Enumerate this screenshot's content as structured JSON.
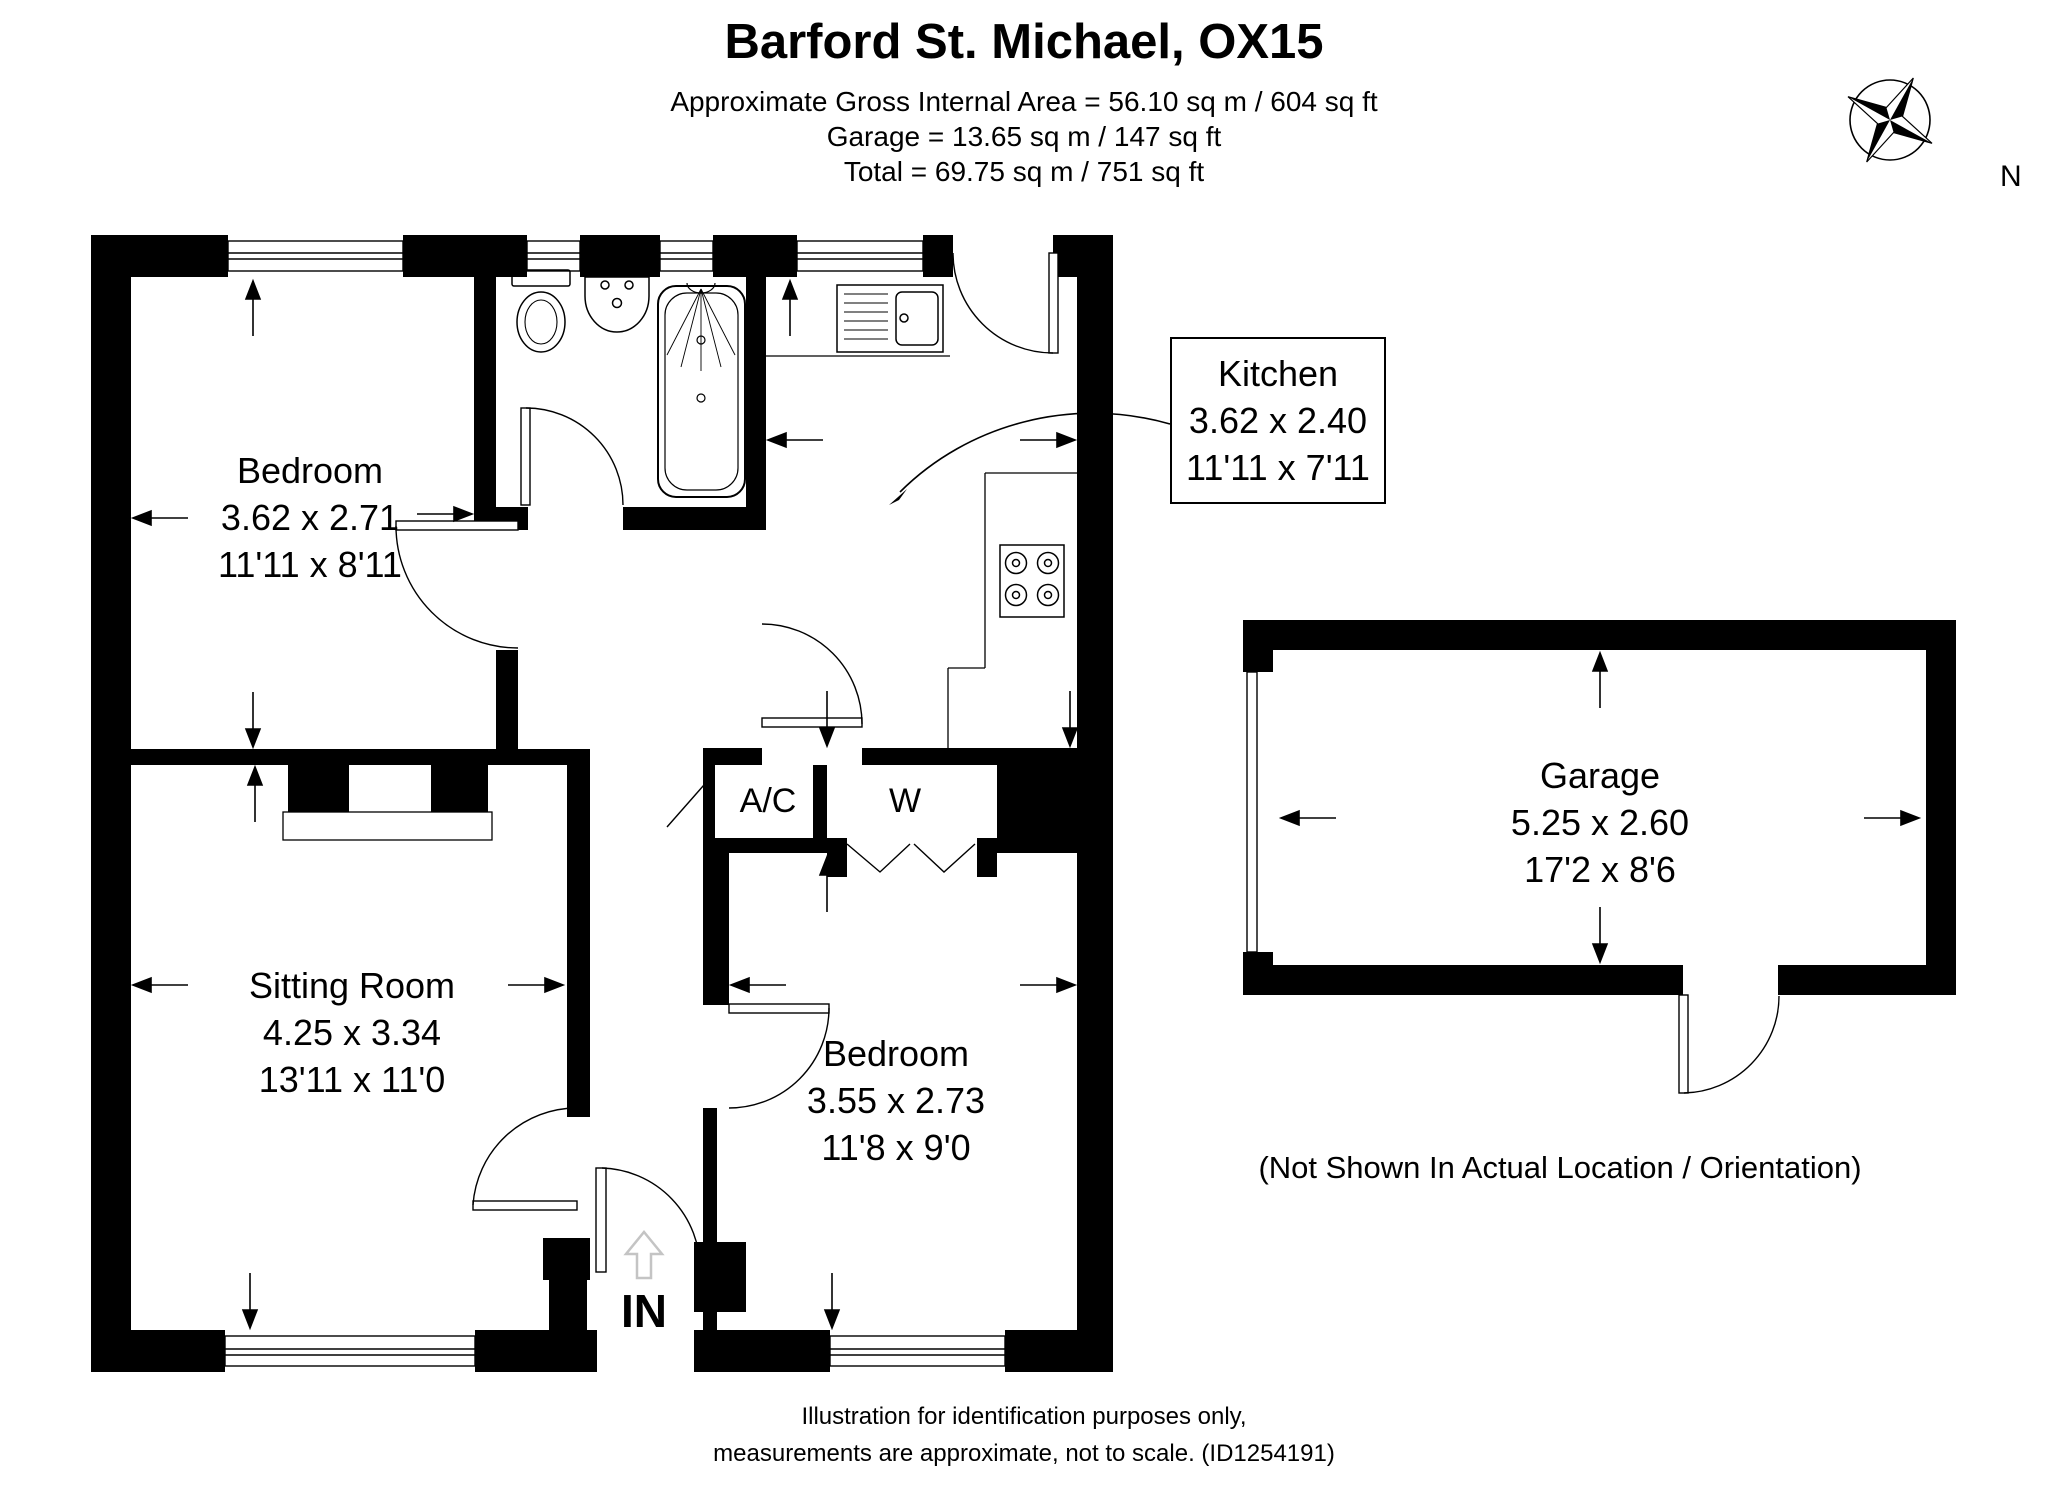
{
  "header": {
    "title": "Barford St. Michael, OX15",
    "line1": "Approximate Gross Internal Area = 56.10 sq m / 604 sq ft",
    "line2": "Garage = 13.65 sq m / 147 sq ft",
    "line3": "Total = 69.75 sq m / 751 sq ft"
  },
  "compass": {
    "north_label": "N"
  },
  "rooms": {
    "bedroom1": {
      "name": "Bedroom",
      "metric": "3.62 x 2.71",
      "imperial": "11'11 x 8'11"
    },
    "kitchen": {
      "name": "Kitchen",
      "metric": "3.62 x 2.40",
      "imperial": "11'11 x 7'11"
    },
    "sitting_room": {
      "name": "Sitting Room",
      "metric": "4.25 x 3.34",
      "imperial": "13'11 x 11'0"
    },
    "bedroom2": {
      "name": "Bedroom",
      "metric": "3.55 x 2.73",
      "imperial": "11'8 x 9'0"
    },
    "garage": {
      "name": "Garage",
      "metric": "5.25 x 2.60",
      "imperial": "17'2 x 8'6"
    },
    "airing_cupboard": {
      "name": "A/C"
    },
    "wardrobe": {
      "name": "W"
    }
  },
  "annotations": {
    "entrance": "IN",
    "garage_note": "(Not Shown In Actual Location / Orientation)",
    "footer_line1": "Illustration for identification purposes only,",
    "footer_line2": "measurements are approximate, not to scale. (ID1254191)"
  },
  "colors": {
    "wall": "#000000",
    "background": "#ffffff",
    "line": "#000000",
    "entry_arrow_gray": "#c4c4c4"
  }
}
